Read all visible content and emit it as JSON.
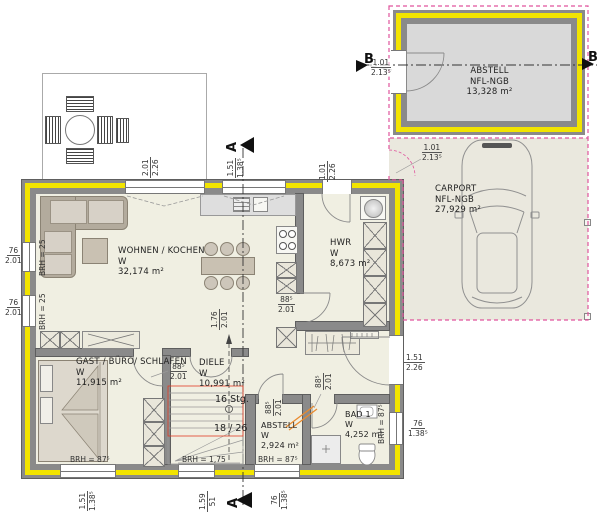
{
  "rooms": {
    "wohnen": {
      "line1": "WOHNEN / KOCHEN",
      "line2": "W",
      "line3": "32,174 m²"
    },
    "gast": {
      "line1": "GAST / BÜRO/ SCHLAFEN",
      "line2": "W",
      "line3": "11,915 m²"
    },
    "diele": {
      "line1": "DIELE",
      "line2": "W",
      "line3": "10,991 m²"
    },
    "abstell": {
      "line1": "ABSTELL",
      "line2": "W",
      "line3": "2,924 m²"
    },
    "bad": {
      "line1": "BAD 1",
      "line2": "W",
      "line3": "4,252 m²"
    },
    "hwr": {
      "line1": "HWR",
      "line2": "W",
      "line3": "8,673 m²"
    },
    "garage": {
      "line1": "ABSTELL",
      "line2": "NFL-NGB",
      "line3": "13,328 m²"
    },
    "carport": {
      "line1": "CARPORT",
      "line2": "NFL-NGB",
      "line3": "27,929 m²"
    }
  },
  "stairs": {
    "count": "16 Stg.",
    "rise_run": "18 / 26"
  },
  "markers": {
    "section_a": "A",
    "section_b": "B"
  },
  "dims": {
    "terrace_door": {
      "w": "2.01",
      "h": "2.26"
    },
    "kitchen_window": {
      "w": "1.51",
      "h": "1.38⁵"
    },
    "back_door": {
      "w": "1.01",
      "h": "2.26"
    },
    "garage_door": {
      "w": "1.01",
      "h": "2.13⁵"
    },
    "carport_opening": {
      "w": "1.01",
      "h": "2.13⁵"
    },
    "left_window_1": {
      "w": "76",
      "h": "2.01"
    },
    "left_window_2": {
      "w": "76",
      "h": "2.01"
    },
    "gast_window": {
      "w": "1.51",
      "h": "1.38⁵"
    },
    "diele_window": {
      "w": "1.59",
      "h": "51"
    },
    "abstell_window": {
      "w": "76",
      "h": "1.38⁵"
    },
    "bad_window": {
      "w": "76",
      "h": "1.38⁵"
    },
    "entrance_door": {
      "w": "1.51",
      "h": "2.26"
    },
    "door_gast": {
      "w": "88⁵",
      "h": "2.01"
    },
    "door_hwr": {
      "w": "88⁵",
      "h": "2.01"
    },
    "door_abstell": {
      "w": "88⁵",
      "h": "2.01"
    },
    "door_bad": {
      "w": "88⁵",
      "h": "2.01"
    },
    "door_living": {
      "w": "1.76",
      "h": "2.01"
    }
  },
  "sills": {
    "left_1": "BRH = 25",
    "left_2": "BRH = 25",
    "gast": "BRH = 87⁵",
    "diele": "BRH = 1,75",
    "abstell": "BRH = 87⁵",
    "bad": "BRH = 87⁵"
  },
  "colors": {
    "wall": "#8a8a8a",
    "insulation": "#f2e400",
    "floor": "#f0efe2",
    "garage_floor": "#d9d9d9",
    "carport_floor": "#eae8de",
    "boundary_pink": "#e0559d",
    "marking_red": "#e23b24",
    "marking_orange": "#e98a2e"
  }
}
